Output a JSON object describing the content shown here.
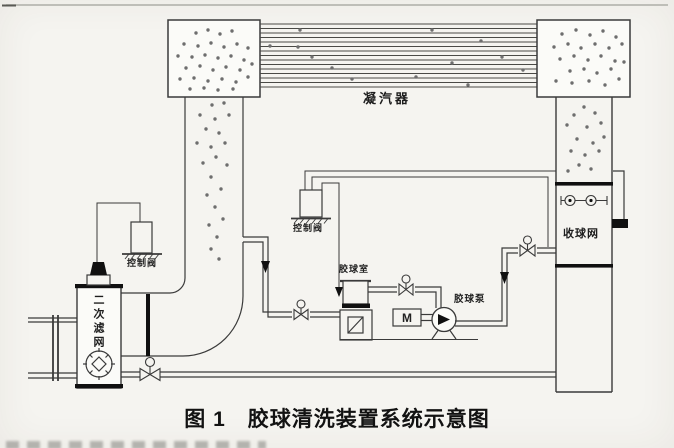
{
  "page": {
    "caption": "图 1　胶球清洗装置系统示意图"
  },
  "labels": {
    "condenser": "凝汽器",
    "control_valve_left": "控制阀",
    "control_valve_mid": "控制阀",
    "secondary_filter": "二次滤网",
    "ball_chamber": "胶球室",
    "ball_pump": "胶球泵",
    "ball_screen": "收球网",
    "motor": "M"
  },
  "colors": {
    "paper": "#f5f4f0",
    "ink": "#3a3a3a",
    "ball": "#6e6e6e",
    "solid": "#101010"
  },
  "diagram": {
    "tube_x": [
      260,
      537
    ],
    "tube_ys": [
      24,
      28.5,
      33,
      37.5,
      42,
      46.5,
      51,
      55.5,
      60,
      64.5,
      69,
      73.5,
      78,
      82.5,
      87
    ],
    "balls": {
      "left-waterbox": [
        [
          196,
          33
        ],
        [
          208,
          30
        ],
        [
          220,
          34
        ],
        [
          232,
          31
        ],
        [
          184,
          44
        ],
        [
          198,
          46
        ],
        [
          211,
          43
        ],
        [
          224,
          47
        ],
        [
          237,
          44
        ],
        [
          248,
          48
        ],
        [
          178,
          56
        ],
        [
          192,
          57
        ],
        [
          205,
          55
        ],
        [
          218,
          58
        ],
        [
          231,
          56
        ],
        [
          244,
          60
        ],
        [
          186,
          68
        ],
        [
          200,
          66
        ],
        [
          213,
          70
        ],
        [
          226,
          67
        ],
        [
          240,
          70
        ],
        [
          252,
          64
        ],
        [
          180,
          79
        ],
        [
          194,
          78
        ],
        [
          208,
          81
        ],
        [
          222,
          79
        ],
        [
          236,
          82
        ],
        [
          248,
          77
        ],
        [
          190,
          89
        ],
        [
          204,
          88
        ],
        [
          218,
          90
        ],
        [
          233,
          89
        ]
      ],
      "left-duct": [
        [
          212,
          105
        ],
        [
          224,
          103
        ],
        [
          200,
          115
        ],
        [
          215,
          119
        ],
        [
          229,
          115
        ],
        [
          206,
          129
        ],
        [
          219,
          133
        ],
        [
          197,
          143
        ],
        [
          211,
          147
        ],
        [
          225,
          143
        ],
        [
          216,
          157
        ],
        [
          203,
          163
        ],
        [
          227,
          165
        ],
        [
          211,
          177
        ],
        [
          221,
          189
        ],
        [
          207,
          195
        ],
        [
          215,
          207
        ],
        [
          223,
          219
        ],
        [
          209,
          225
        ],
        [
          217,
          237
        ],
        [
          211,
          249
        ],
        [
          219,
          259
        ]
      ],
      "tubes": [
        [
          270,
          46
        ],
        [
          298,
          47
        ],
        [
          312,
          57
        ],
        [
          332,
          68
        ],
        [
          352,
          79
        ],
        [
          300,
          30
        ],
        [
          416,
          77
        ],
        [
          452,
          63
        ],
        [
          481,
          41
        ],
        [
          502,
          57
        ],
        [
          523,
          70
        ],
        [
          468,
          85
        ],
        [
          432,
          30
        ]
      ],
      "right-waterbox": [
        [
          562,
          34
        ],
        [
          576,
          30
        ],
        [
          590,
          35
        ],
        [
          603,
          31
        ],
        [
          616,
          37
        ],
        [
          554,
          47
        ],
        [
          568,
          44
        ],
        [
          581,
          48
        ],
        [
          595,
          44
        ],
        [
          609,
          48
        ],
        [
          622,
          44
        ],
        [
          560,
          59
        ],
        [
          574,
          56
        ],
        [
          588,
          60
        ],
        [
          601,
          56
        ],
        [
          615,
          61
        ],
        [
          570,
          71
        ],
        [
          584,
          69
        ],
        [
          597,
          73
        ],
        [
          611,
          69
        ],
        [
          556,
          81
        ],
        [
          572,
          83
        ],
        [
          589,
          81
        ],
        [
          605,
          85
        ],
        [
          619,
          79
        ],
        [
          624,
          62
        ]
      ],
      "right-duct": [
        [
          584,
          107
        ],
        [
          574,
          115
        ],
        [
          595,
          113
        ],
        [
          567,
          125
        ],
        [
          587,
          127
        ],
        [
          601,
          123
        ],
        [
          577,
          139
        ],
        [
          593,
          143
        ],
        [
          604,
          137
        ],
        [
          571,
          151
        ],
        [
          585,
          155
        ],
        [
          599,
          151
        ],
        [
          579,
          165
        ],
        [
          591,
          169
        ],
        [
          568,
          171
        ]
      ]
    }
  }
}
